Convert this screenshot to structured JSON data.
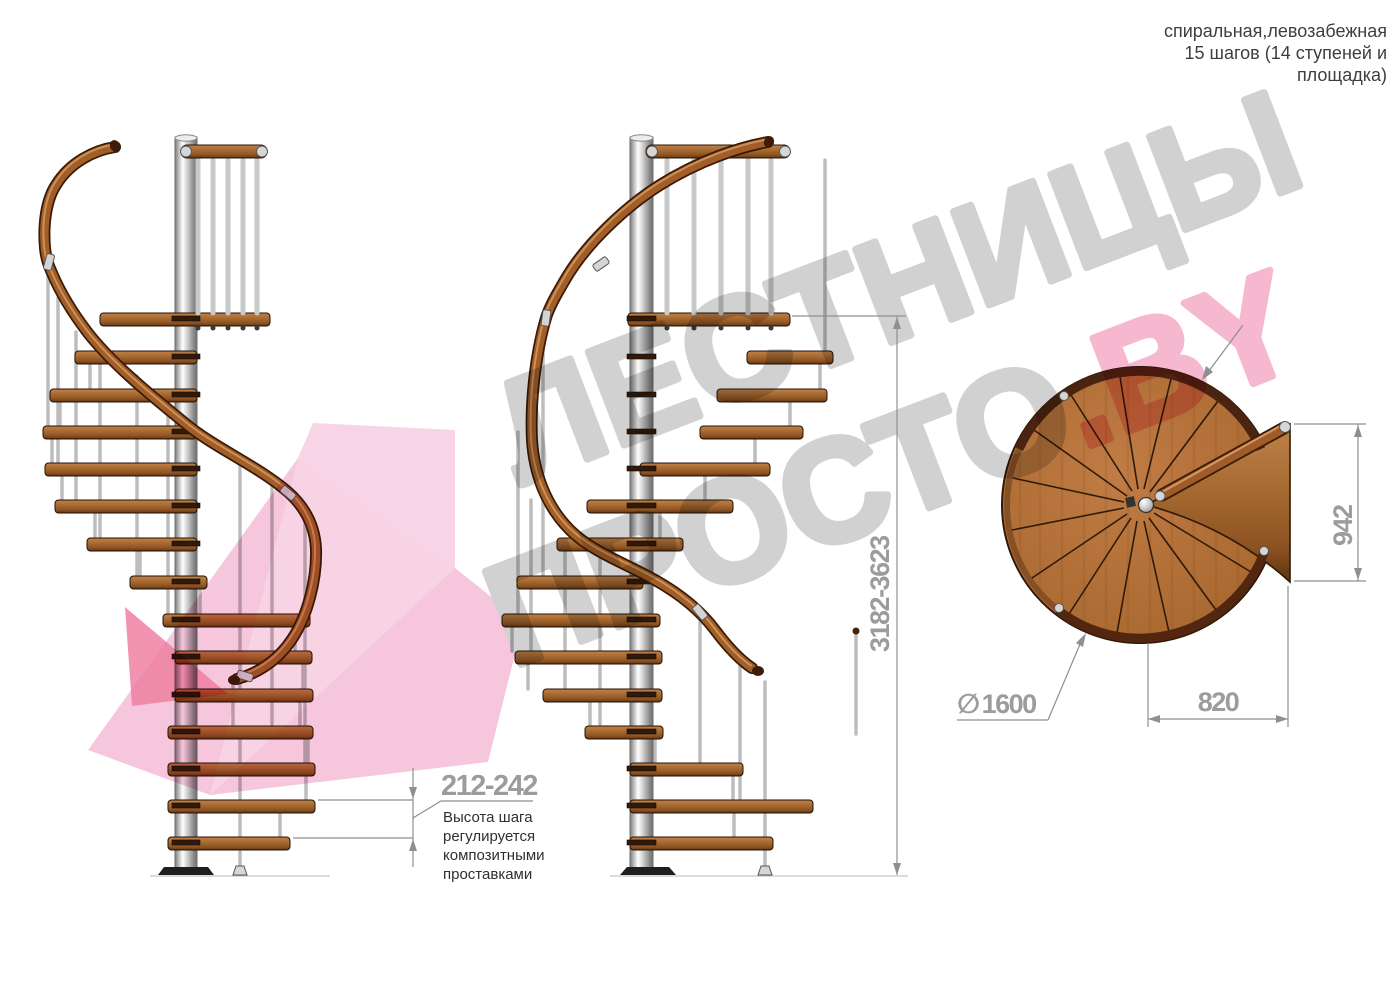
{
  "header": {
    "line1": "спиральная,левозабежная",
    "line2": "15 шагов (14 ступеней и",
    "line3": "площадка)"
  },
  "dims": {
    "step_height": "212-242",
    "step_height_note": [
      "Высота шага",
      "регулируется",
      "композитными",
      "проставками"
    ],
    "total_height": "3182-3623",
    "landing_length": "942",
    "diameter_symbol": "∅",
    "diameter_value": "1600",
    "landing_width": "820"
  },
  "watermark": {
    "line1": "ЛЕСТНИЦЫ",
    "line2": "ПРОСТО",
    "accent": ".BY",
    "text_color": "#cbcbcb",
    "accent_color": "#f4aec8",
    "logo_pink": "#f5bfd8"
  },
  "colors": {
    "wood": "#a4682f",
    "handrail": "#a15e28",
    "metal_column": "#d2d2d2",
    "dimension_gray": "#9c9c9c",
    "note_text": "#2c3034",
    "title_text": "#3b3e42"
  }
}
